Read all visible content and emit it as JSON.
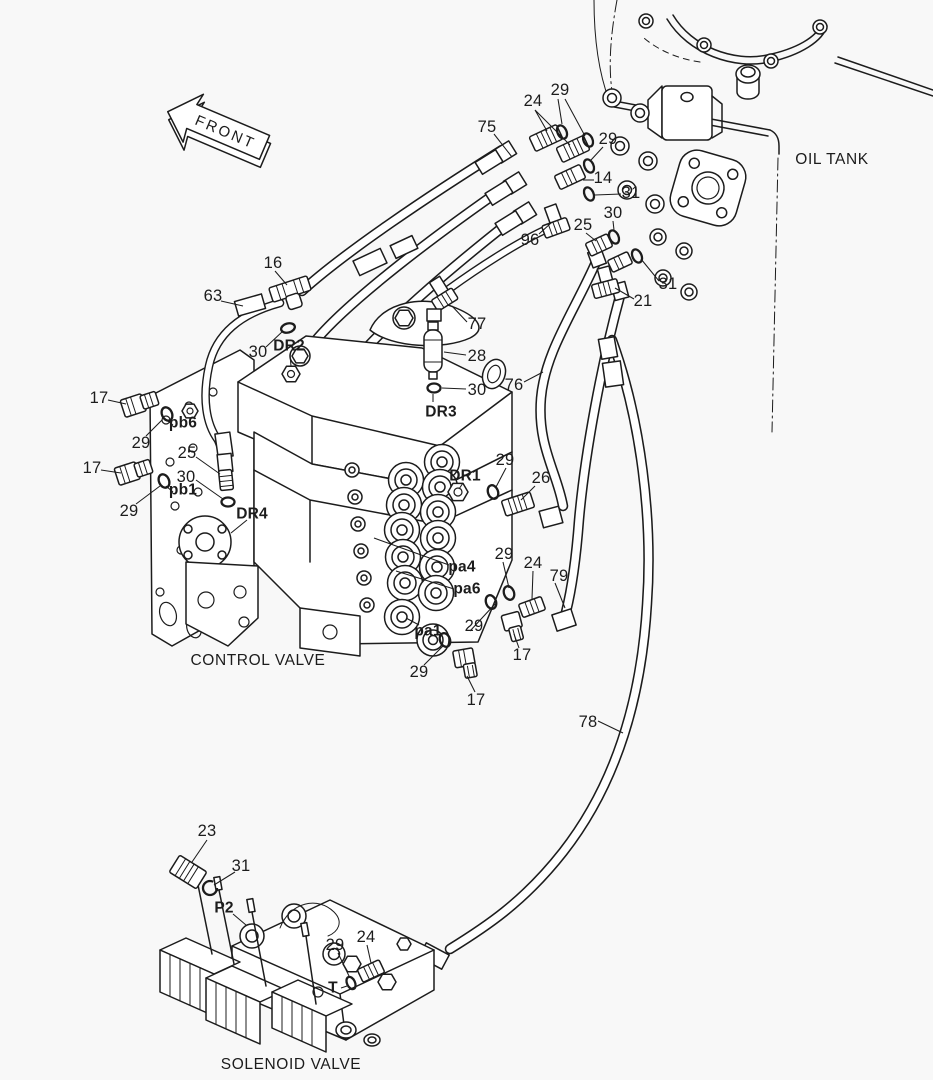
{
  "colors": {
    "background": "#f8f8f8",
    "line": "#1c1c1c"
  },
  "labels": {
    "front_arrow": "FRONT",
    "oil_tank": "OIL TANK",
    "control_valve": "CONTROL VALVE",
    "solenoid_valve": "SOLENOID VALVE"
  },
  "callouts": [
    {
      "text": "75",
      "x": 487,
      "y": 127,
      "bold": false
    },
    {
      "text": "24",
      "x": 533,
      "y": 101,
      "bold": false
    },
    {
      "text": "29",
      "x": 560,
      "y": 90,
      "bold": false
    },
    {
      "text": "29",
      "x": 608,
      "y": 139,
      "bold": false
    },
    {
      "text": "14",
      "x": 603,
      "y": 178,
      "bold": false
    },
    {
      "text": "31",
      "x": 631,
      "y": 193,
      "bold": false
    },
    {
      "text": "30",
      "x": 613,
      "y": 213,
      "bold": false
    },
    {
      "text": "25",
      "x": 583,
      "y": 225,
      "bold": false
    },
    {
      "text": "96",
      "x": 530,
      "y": 240,
      "bold": false
    },
    {
      "text": "31",
      "x": 668,
      "y": 284,
      "bold": false
    },
    {
      "text": "21",
      "x": 643,
      "y": 301,
      "bold": false
    },
    {
      "text": "16",
      "x": 273,
      "y": 263,
      "bold": false
    },
    {
      "text": "63",
      "x": 213,
      "y": 296,
      "bold": false
    },
    {
      "text": "30",
      "x": 258,
      "y": 352,
      "bold": false
    },
    {
      "text": "DR2",
      "x": 289,
      "y": 346,
      "bold": true
    },
    {
      "text": "77",
      "x": 477,
      "y": 324,
      "bold": false
    },
    {
      "text": "28",
      "x": 477,
      "y": 356,
      "bold": false
    },
    {
      "text": "30",
      "x": 477,
      "y": 390,
      "bold": false
    },
    {
      "text": "DR3",
      "x": 441,
      "y": 412,
      "bold": true
    },
    {
      "text": "76",
      "x": 514,
      "y": 385,
      "bold": false
    },
    {
      "text": "17",
      "x": 99,
      "y": 398,
      "bold": false
    },
    {
      "text": "pb6",
      "x": 183,
      "y": 423,
      "bold": true
    },
    {
      "text": "29",
      "x": 141,
      "y": 443,
      "bold": false
    },
    {
      "text": "25",
      "x": 187,
      "y": 453,
      "bold": false
    },
    {
      "text": "17",
      "x": 92,
      "y": 468,
      "bold": false
    },
    {
      "text": "30",
      "x": 186,
      "y": 477,
      "bold": false
    },
    {
      "text": "pb1",
      "x": 183,
      "y": 490,
      "bold": true
    },
    {
      "text": "29",
      "x": 129,
      "y": 511,
      "bold": false
    },
    {
      "text": "DR4",
      "x": 252,
      "y": 514,
      "bold": true
    },
    {
      "text": "DR1",
      "x": 465,
      "y": 476,
      "bold": true
    },
    {
      "text": "29",
      "x": 505,
      "y": 460,
      "bold": false
    },
    {
      "text": "26",
      "x": 541,
      "y": 478,
      "bold": false
    },
    {
      "text": "pa4",
      "x": 462,
      "y": 567,
      "bold": true
    },
    {
      "text": "pa6",
      "x": 467,
      "y": 589,
      "bold": true
    },
    {
      "text": "29",
      "x": 504,
      "y": 554,
      "bold": false
    },
    {
      "text": "24",
      "x": 533,
      "y": 563,
      "bold": false
    },
    {
      "text": "79",
      "x": 559,
      "y": 576,
      "bold": false
    },
    {
      "text": "pa1",
      "x": 428,
      "y": 631,
      "bold": true
    },
    {
      "text": "29",
      "x": 474,
      "y": 626,
      "bold": false
    },
    {
      "text": "29",
      "x": 419,
      "y": 672,
      "bold": false
    },
    {
      "text": "17",
      "x": 522,
      "y": 655,
      "bold": false
    },
    {
      "text": "17",
      "x": 476,
      "y": 700,
      "bold": false
    },
    {
      "text": "78",
      "x": 588,
      "y": 722,
      "bold": false
    },
    {
      "text": "23",
      "x": 207,
      "y": 831,
      "bold": false
    },
    {
      "text": "31",
      "x": 241,
      "y": 866,
      "bold": false
    },
    {
      "text": "P2",
      "x": 224,
      "y": 908,
      "bold": true
    },
    {
      "text": "29",
      "x": 335,
      "y": 945,
      "bold": false
    },
    {
      "text": "24",
      "x": 366,
      "y": 937,
      "bold": false
    },
    {
      "text": "T",
      "x": 333,
      "y": 988,
      "bold": true
    }
  ],
  "section_labels": [
    {
      "id": "oil_tank",
      "x": 832,
      "y": 160
    },
    {
      "id": "control_valve",
      "x": 258,
      "y": 661
    },
    {
      "id": "solenoid_valve",
      "x": 291,
      "y": 1065
    }
  ]
}
